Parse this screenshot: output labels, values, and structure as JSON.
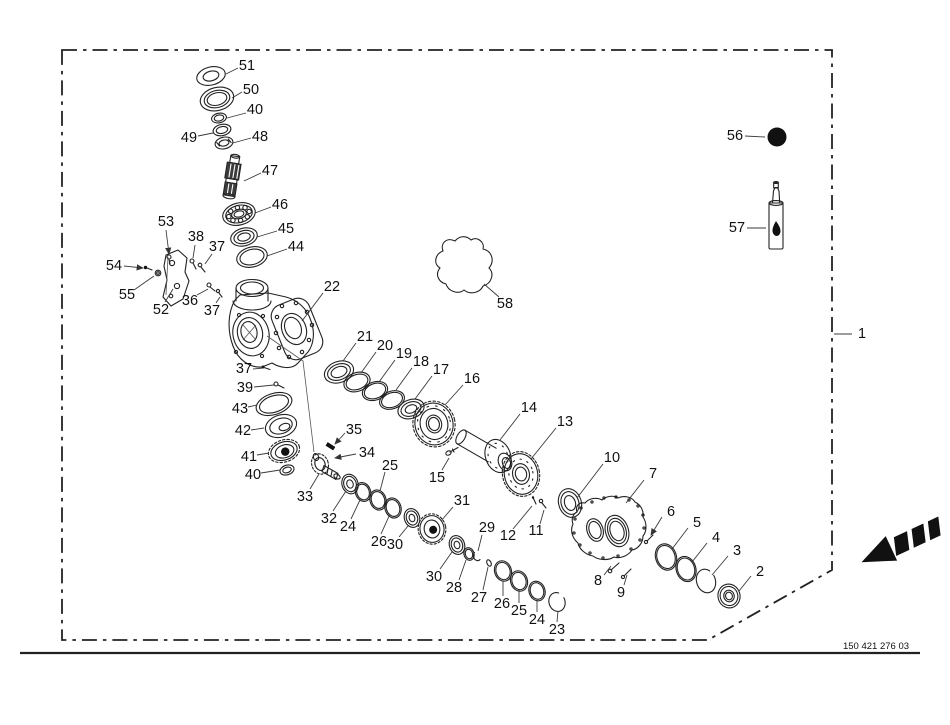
{
  "document": {
    "part_code": "150 421 276 03"
  },
  "colors": {
    "ink": "#222222",
    "dark_fill": "#111111",
    "background": "#ffffff"
  },
  "symbols": {
    "grease_dot": "filled-circle-icon",
    "sealant_tube": "sealant-tube-icon",
    "direction_arrow": "direction-arrow-icon",
    "gasket_outline": "gasket-blob-outline"
  },
  "callouts": [
    {
      "n": "1",
      "tx": 862,
      "ty": 334,
      "l": [
        852,
        334,
        834,
        334
      ]
    },
    {
      "n": "2",
      "tx": 760,
      "ty": 572,
      "l": [
        751,
        576,
        739,
        591
      ]
    },
    {
      "n": "3",
      "tx": 737,
      "ty": 551,
      "l": [
        728,
        556,
        712,
        575
      ]
    },
    {
      "n": "4",
      "tx": 716,
      "ty": 538,
      "l": [
        707,
        543,
        692,
        562
      ]
    },
    {
      "n": "5",
      "tx": 697,
      "ty": 523,
      "l": [
        688,
        528,
        672,
        549
      ]
    },
    {
      "n": "6",
      "tx": 671,
      "ty": 512,
      "l": [
        662,
        517,
        651,
        535
      ],
      "arrow": true
    },
    {
      "n": "7",
      "tx": 653,
      "ty": 474,
      "l": [
        644,
        480,
        626,
        503
      ]
    },
    {
      "n": "8",
      "tx": 598,
      "ty": 581,
      "l": [
        604,
        575,
        611,
        566
      ]
    },
    {
      "n": "9",
      "tx": 621,
      "ty": 593,
      "l": [
        624,
        585,
        627,
        575
      ]
    },
    {
      "n": "10",
      "tx": 612,
      "ty": 458,
      "l": [
        603,
        464,
        577,
        498
      ]
    },
    {
      "n": "11",
      "tx": 536,
      "ty": 531,
      "l": [
        540,
        524,
        544,
        510
      ]
    },
    {
      "n": "12",
      "tx": 508,
      "ty": 536,
      "l": [
        513,
        529,
        532,
        506
      ]
    },
    {
      "n": "13",
      "tx": 565,
      "ty": 422,
      "l": [
        556,
        428,
        531,
        459
      ]
    },
    {
      "n": "14",
      "tx": 529,
      "ty": 408,
      "l": [
        520,
        414,
        500,
        440
      ]
    },
    {
      "n": "15",
      "tx": 437,
      "ty": 478,
      "l": [
        442,
        470,
        449,
        458
      ]
    },
    {
      "n": "16",
      "tx": 472,
      "ty": 379,
      "l": [
        463,
        385,
        445,
        405
      ]
    },
    {
      "n": "17",
      "tx": 441,
      "ty": 370,
      "l": [
        432,
        376,
        415,
        399
      ]
    },
    {
      "n": "18",
      "tx": 421,
      "ty": 362,
      "l": [
        412,
        368,
        396,
        390
      ]
    },
    {
      "n": "19",
      "tx": 404,
      "ty": 354,
      "l": [
        395,
        360,
        379,
        382
      ]
    },
    {
      "n": "20",
      "tx": 385,
      "ty": 346,
      "l": [
        376,
        352,
        361,
        373
      ]
    },
    {
      "n": "21",
      "tx": 365,
      "ty": 337,
      "l": [
        356,
        343,
        343,
        361
      ]
    },
    {
      "n": "22",
      "tx": 332,
      "ty": 287,
      "l": [
        323,
        293,
        302,
        321
      ]
    },
    {
      "n": "23",
      "tx": 557,
      "ty": 630,
      "l": [
        557,
        622,
        558,
        611
      ]
    },
    {
      "n": "24",
      "tx": 537,
      "ty": 620,
      "l": [
        537,
        612,
        537,
        600
      ]
    },
    {
      "n": "25",
      "tx": 519,
      "ty": 611,
      "l": [
        519,
        603,
        519,
        590
      ]
    },
    {
      "n": "26",
      "tx": 502,
      "ty": 604,
      "l": [
        503,
        596,
        503,
        581
      ]
    },
    {
      "n": "27",
      "tx": 479,
      "ty": 598,
      "l": [
        483,
        590,
        488,
        567
      ]
    },
    {
      "n": "28",
      "tx": 454,
      "ty": 588,
      "l": [
        459,
        580,
        466,
        560
      ]
    },
    {
      "n": "29",
      "tx": 487,
      "ty": 528,
      "l": [
        482,
        535,
        478,
        551
      ]
    },
    {
      "n": "30",
      "tx": 434,
      "ty": 577,
      "l": [
        440,
        569,
        452,
        552
      ]
    },
    {
      "n": "31",
      "tx": 462,
      "ty": 501,
      "l": [
        453,
        507,
        441,
        521
      ]
    },
    {
      "n": "30",
      "tx": 395,
      "ty": 545,
      "l": [
        399,
        537,
        408,
        526
      ]
    },
    {
      "n": "26",
      "tx": 379,
      "ty": 542,
      "l": [
        381,
        534,
        390,
        514
      ]
    },
    {
      "n": "24",
      "tx": 348,
      "ty": 527,
      "l": [
        351,
        519,
        360,
        500
      ]
    },
    {
      "n": "32",
      "tx": 329,
      "ty": 519,
      "l": [
        333,
        511,
        346,
        491
      ]
    },
    {
      "n": "33",
      "tx": 305,
      "ty": 497,
      "l": [
        310,
        489,
        319,
        474
      ]
    },
    {
      "n": "25",
      "tx": 390,
      "ty": 466,
      "l": [
        385,
        472,
        380,
        491
      ]
    },
    {
      "n": "34",
      "tx": 367,
      "ty": 453,
      "l": [
        356,
        454,
        335,
        458
      ],
      "arrow": true
    },
    {
      "n": "35",
      "tx": 354,
      "ty": 430,
      "l": [
        345,
        433,
        335,
        444
      ],
      "arrow": true
    },
    {
      "n": "36",
      "tx": 190,
      "ty": 301,
      "l": [
        197,
        295,
        208,
        289
      ]
    },
    {
      "n": "37",
      "tx": 217,
      "ty": 247,
      "l": [
        212,
        254,
        205,
        264
      ]
    },
    {
      "n": "37",
      "tx": 212,
      "ty": 311,
      "l": [
        216,
        303,
        220,
        297
      ]
    },
    {
      "n": "37",
      "tx": 244,
      "ty": 369,
      "l": [
        253,
        369,
        263,
        368
      ]
    },
    {
      "n": "38",
      "tx": 196,
      "ty": 237,
      "l": [
        195,
        245,
        193,
        258
      ]
    },
    {
      "n": "39",
      "tx": 245,
      "ty": 388,
      "l": [
        254,
        387,
        274,
        385
      ]
    },
    {
      "n": "40",
      "tx": 255,
      "ty": 110,
      "l": [
        246,
        113,
        227,
        118
      ]
    },
    {
      "n": "40",
      "tx": 253,
      "ty": 475,
      "l": [
        261,
        473,
        280,
        470
      ]
    },
    {
      "n": "41",
      "tx": 249,
      "ty": 457,
      "l": [
        257,
        455,
        269,
        453
      ]
    },
    {
      "n": "42",
      "tx": 243,
      "ty": 431,
      "l": [
        251,
        430,
        264,
        428
      ]
    },
    {
      "n": "43",
      "tx": 240,
      "ty": 409,
      "l": [
        248,
        407,
        257,
        405
      ]
    },
    {
      "n": "44",
      "tx": 296,
      "ty": 247,
      "l": [
        287,
        249,
        267,
        256
      ]
    },
    {
      "n": "45",
      "tx": 286,
      "ty": 229,
      "l": [
        277,
        231,
        257,
        237
      ]
    },
    {
      "n": "46",
      "tx": 280,
      "ty": 205,
      "l": [
        271,
        207,
        255,
        213
      ]
    },
    {
      "n": "47",
      "tx": 270,
      "ty": 171,
      "l": [
        261,
        173,
        244,
        181
      ]
    },
    {
      "n": "48",
      "tx": 260,
      "ty": 137,
      "l": [
        251,
        138,
        233,
        143
      ]
    },
    {
      "n": "49",
      "tx": 189,
      "ty": 138,
      "l": [
        198,
        136,
        213,
        133
      ]
    },
    {
      "n": "50",
      "tx": 251,
      "ty": 90,
      "l": [
        242,
        92,
        232,
        98
      ]
    },
    {
      "n": "51",
      "tx": 247,
      "ty": 66,
      "l": [
        238,
        68,
        226,
        74
      ]
    },
    {
      "n": "52",
      "tx": 161,
      "ty": 310,
      "l": [
        165,
        302,
        173,
        289
      ]
    },
    {
      "n": "53",
      "tx": 166,
      "ty": 222,
      "l": [
        166,
        230,
        169,
        254
      ],
      "arrow": true
    },
    {
      "n": "54",
      "tx": 114,
      "ty": 266,
      "l": [
        124,
        266,
        143,
        268
      ],
      "arrow": true
    },
    {
      "n": "55",
      "tx": 127,
      "ty": 295,
      "l": [
        134,
        290,
        154,
        276
      ]
    },
    {
      "n": "56",
      "tx": 735,
      "ty": 136,
      "l": [
        745,
        136,
        765,
        137
      ]
    },
    {
      "n": "57",
      "tx": 737,
      "ty": 228,
      "l": [
        747,
        228,
        766,
        228
      ]
    },
    {
      "n": "58",
      "tx": 505,
      "ty": 304,
      "l": [
        499,
        297,
        484,
        284
      ]
    }
  ]
}
